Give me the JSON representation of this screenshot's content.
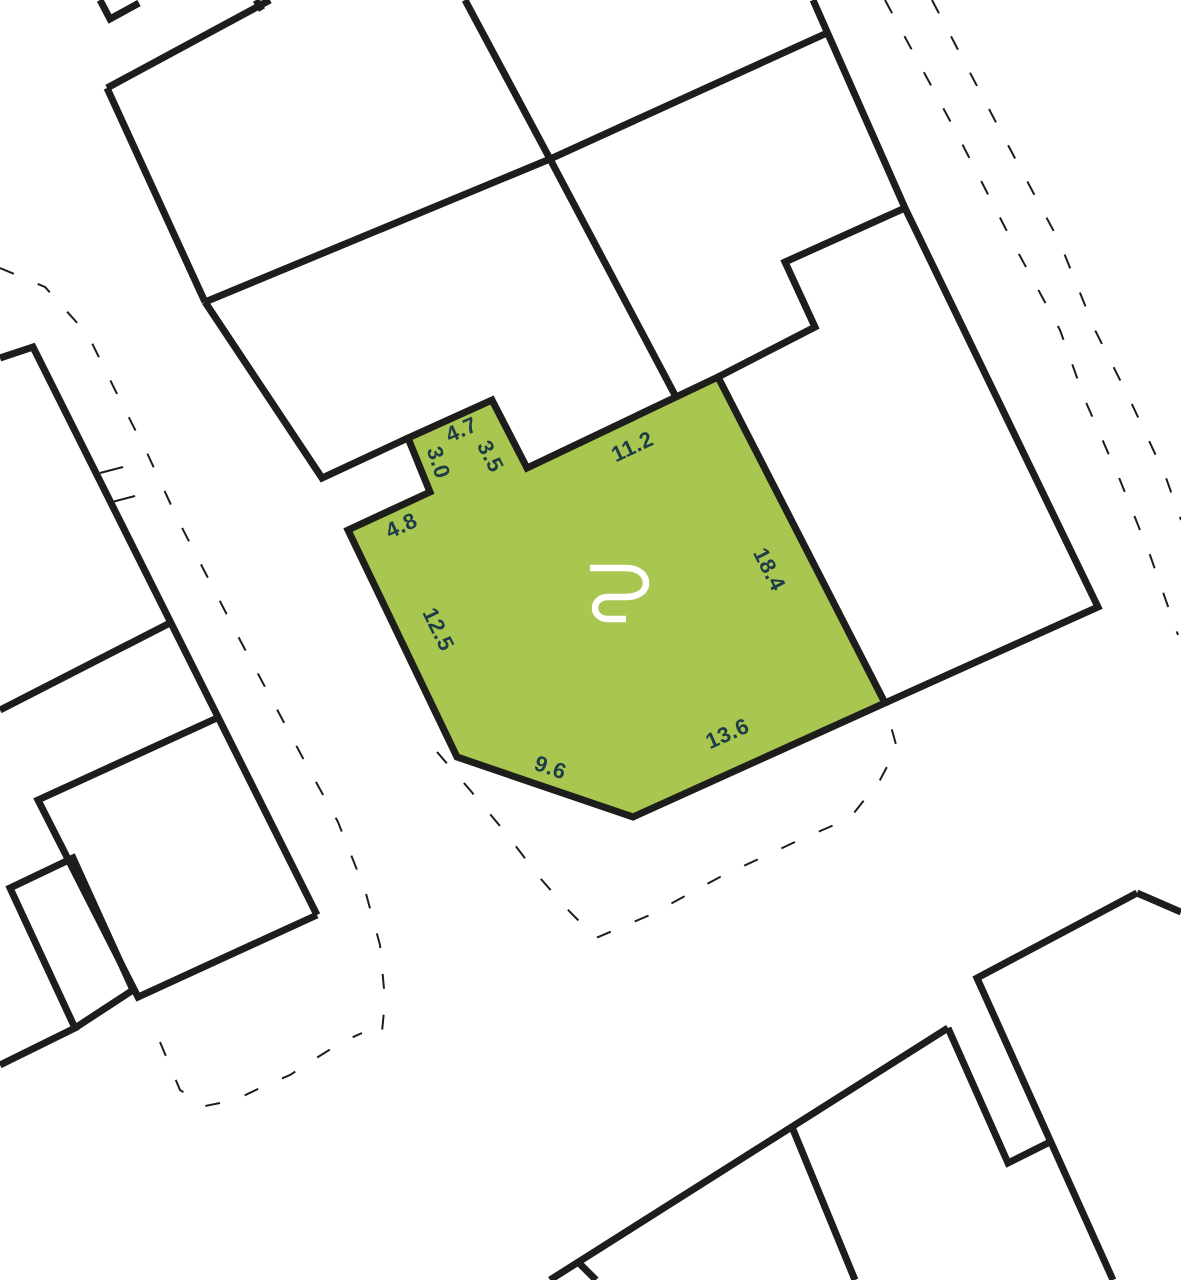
{
  "map": {
    "kind": "cadastral-parcel-map",
    "colors": {
      "background": "#ffffff",
      "boundary": "#1d1d1b",
      "parcel_fill": "#a9c750",
      "parcel_stroke": "#1d1d1b",
      "label": "#1e3c47",
      "logo": "#ffffff"
    },
    "parcel": {
      "logo_icon": "brand-monogram-icon",
      "logo_position": {
        "x": 589,
        "y": 563
      },
      "outline": [
        [
          348,
          530
        ],
        [
          430,
          492
        ],
        [
          408,
          438
        ],
        [
          492,
          400
        ],
        [
          527,
          468
        ],
        [
          718,
          377
        ],
        [
          885,
          703
        ],
        [
          633,
          817
        ],
        [
          457,
          757
        ]
      ],
      "dimension_labels": [
        {
          "value": "4.7",
          "x": 462,
          "y": 431,
          "rotation": -24
        },
        {
          "value": "3.5",
          "x": 489,
          "y": 457,
          "rotation": 63
        },
        {
          "value": "3.0",
          "x": 437,
          "y": 463,
          "rotation": 72
        },
        {
          "value": "11.2",
          "x": 633,
          "y": 448,
          "rotation": -25
        },
        {
          "value": "4.8",
          "x": 402,
          "y": 527,
          "rotation": -25
        },
        {
          "value": "18.4",
          "x": 768,
          "y": 570,
          "rotation": 63
        },
        {
          "value": "12.5",
          "x": 437,
          "y": 630,
          "rotation": 64
        },
        {
          "value": "9.6",
          "x": 550,
          "y": 769,
          "rotation": 19
        },
        {
          "value": "13.6",
          "x": 728,
          "y": 735,
          "rotation": -24
        }
      ]
    },
    "boundaries": {
      "solid": [
        [
          [
            100,
            0
          ],
          [
            110,
            19
          ],
          [
            139,
            3
          ]
        ],
        [
          [
            107,
            88
          ],
          [
            270,
            0
          ]
        ],
        [
          [
            256,
            0
          ],
          [
            262,
            10
          ]
        ],
        [
          [
            107,
            88
          ],
          [
            205,
            302
          ]
        ],
        [
          [
            205,
            302
          ],
          [
            550,
            159
          ],
          [
            827,
            33
          ]
        ],
        [
          [
            465,
            0
          ],
          [
            550,
            159
          ]
        ],
        [
          [
            550,
            159
          ],
          [
            676,
            397
          ]
        ],
        [
          [
            205,
            302
          ],
          [
            322,
            478
          ],
          [
            408,
            438
          ]
        ],
        [
          [
            813,
            0
          ],
          [
            905,
            208
          ],
          [
            1098,
            607
          ],
          [
            885,
            703
          ]
        ],
        [
          [
            905,
            208
          ],
          [
            785,
            262
          ],
          [
            815,
            327
          ],
          [
            718,
            377
          ]
        ],
        [
          [
            0,
            358
          ],
          [
            33,
            347
          ],
          [
            317,
            915
          ]
        ],
        [
          [
            170,
            623
          ],
          [
            0,
            710
          ]
        ],
        [
          [
            217,
            718
          ],
          [
            38,
            800
          ],
          [
            138,
            997
          ],
          [
            317,
            915
          ]
        ],
        [
          [
            0,
            1065
          ],
          [
            75,
            1028
          ],
          [
            10,
            888
          ],
          [
            73,
            858
          ],
          [
            133,
            990
          ],
          [
            75,
            1028
          ]
        ],
        [
          [
            1137,
            893
          ],
          [
            1181,
            912
          ]
        ],
        [
          [
            1137,
            893
          ],
          [
            977,
            978
          ],
          [
            1113,
            1280
          ]
        ],
        [
          [
            948,
            1028
          ],
          [
            550,
            1280
          ]
        ],
        [
          [
            948,
            1028
          ],
          [
            1008,
            1163
          ],
          [
            1050,
            1142
          ]
        ],
        [
          [
            792,
            1127
          ],
          [
            855,
            1280
          ]
        ],
        [
          [
            578,
            1262
          ],
          [
            596,
            1280
          ]
        ]
      ],
      "dashed": [
        [
          [
            0,
            268
          ],
          [
            45,
            287
          ],
          [
            88,
            335
          ],
          [
            120,
            400
          ],
          [
            148,
            455
          ],
          [
            178,
            520
          ],
          [
            208,
            578
          ],
          [
            240,
            640
          ],
          [
            272,
            700
          ],
          [
            305,
            762
          ],
          [
            338,
            822
          ],
          [
            365,
            890
          ],
          [
            380,
            945
          ],
          [
            385,
            1000
          ],
          [
            382,
            1032
          ]
        ],
        [
          [
            160,
            1042
          ],
          [
            180,
            1090
          ],
          [
            205,
            1106
          ],
          [
            235,
            1100
          ],
          [
            262,
            1087
          ],
          [
            290,
            1075
          ],
          [
            318,
            1057
          ],
          [
            342,
            1042
          ],
          [
            362,
            1033
          ]
        ],
        [
          [
            437,
            752
          ],
          [
            470,
            790
          ],
          [
            505,
            832
          ],
          [
            540,
            878
          ],
          [
            570,
            912
          ],
          [
            596,
            938
          ],
          [
            650,
            915
          ],
          [
            720,
            877
          ],
          [
            795,
            842
          ],
          [
            850,
            818
          ],
          [
            880,
            780
          ],
          [
            897,
            748
          ],
          [
            888,
            716
          ]
        ],
        [
          [
            885,
            0
          ],
          [
            955,
            130
          ],
          [
            1013,
            243
          ],
          [
            1060,
            330
          ],
          [
            1085,
            400
          ],
          [
            1120,
            480
          ],
          [
            1150,
            555
          ],
          [
            1178,
            635
          ]
        ],
        [
          [
            932,
            0
          ],
          [
            1000,
            130
          ],
          [
            1060,
            243
          ],
          [
            1095,
            330
          ],
          [
            1130,
            400
          ],
          [
            1165,
            475
          ],
          [
            1181,
            520
          ]
        ]
      ],
      "ticks": [
        [
          [
            100,
            473
          ],
          [
            123,
            467
          ]
        ],
        [
          [
            112,
            502
          ],
          [
            135,
            496
          ]
        ]
      ]
    },
    "logo_path": "M 1 5 L 36 5 C 50 5 57 12 57 20 C 57 28 50 34 36 34 L 19 34 C 11 34 6 39 6 45 C 6 51 11 56 19 56 L 37 56"
  }
}
